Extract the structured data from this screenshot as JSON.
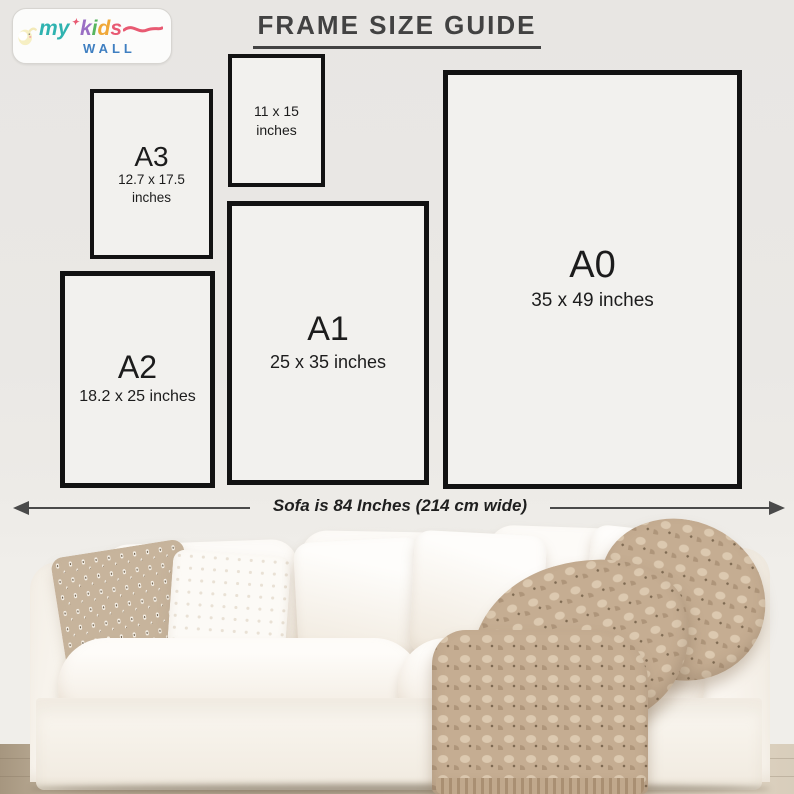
{
  "logo": {
    "word_my": "my",
    "star": "✦",
    "letter_k": "k",
    "letter_i": "i",
    "letter_d": "d",
    "letter_s": "s",
    "word_wall": "WALL",
    "colors": {
      "my": "#2fb3b0",
      "k": "#9a6fc4",
      "i": "#58b55f",
      "d": "#f0a838",
      "s": "#e85a72",
      "wall": "#3f7fc1",
      "star": "#e85a72",
      "elephant": "#f6efc3"
    }
  },
  "title": {
    "text": "FRAME SIZE GUIDE"
  },
  "frames": [
    {
      "size": "11 x 15",
      "unit": "inches"
    },
    {
      "label": "A3",
      "size": "12.7 x 17.5",
      "unit": "inches"
    },
    {
      "label": "A2",
      "size": "18.2 x 25 inches"
    },
    {
      "label": "A1",
      "size": "25 x 35 inches"
    },
    {
      "label": "A0",
      "size": "35 x 49 inches"
    }
  ],
  "sofa": {
    "annotation": "Sofa is 84 Inches (214 cm wide)"
  },
  "colors": {
    "wall": "#e9e7e4",
    "frame_border": "#121212",
    "frame_fill": "#f2f1ee",
    "title_text": "#424242",
    "arrow": "#4a4a4a",
    "sofa_white": "#faf6f0",
    "knit_blanket": "#c5ad92",
    "patterned_pillow": "#c7b49c",
    "floor": "#c2b49e"
  }
}
